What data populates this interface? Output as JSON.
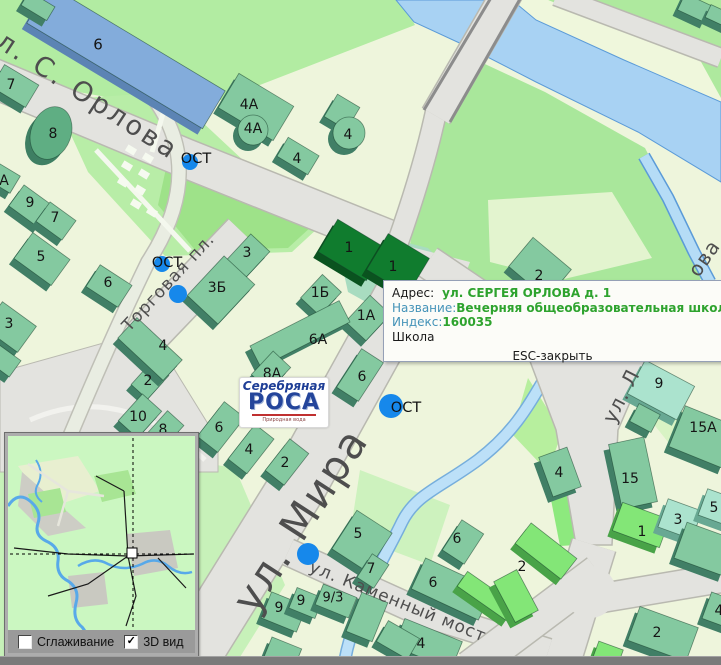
{
  "popup": {
    "address_label": "Адрес:",
    "address_value": "ул. СЕРГЕЯ ОРЛОВА д. 1",
    "name_label": "Название:",
    "name_value": "Вечерняя общеобразовательная школа № 1",
    "index_label": "Индекс:",
    "index_value": "160035",
    "category": "Школа",
    "close_hint": "ESC-закрыть"
  },
  "logo": {
    "line1": "Серебряная",
    "line2": "РОСА",
    "tagline": "Природная вода"
  },
  "minimap": {
    "smoothing_label": "Сглаживание",
    "smoothing_checked": false,
    "view3d_label": "3D вид",
    "view3d_checked": true
  },
  "colors": {
    "water": "#A8D2F3",
    "water_edge": "#5B9BD8",
    "road": "#E3E3DF",
    "road_edge": "#B9B9B0",
    "building_top": "#84C9A0",
    "building_side": "#417F66",
    "school_top": "#107C2E",
    "school_side": "#0A531F",
    "stop_blue": "#1688EB",
    "popup_value_green": "#2EA32E",
    "popup_label_blue": "#4493B8"
  },
  "map": {
    "street_labels": [
      {
        "t": "ул. С. Орлова",
        "x": 80,
        "y": 90,
        "rot": 33,
        "s": 27,
        "ls": 3
      },
      {
        "t": "Торговая пл.",
        "x": 168,
        "y": 282,
        "rot": -47,
        "s": 17,
        "ls": 1
      },
      {
        "t": "ул. Мира",
        "x": 300,
        "y": 520,
        "rot": -57,
        "s": 42,
        "ls": 2
      },
      {
        "t": "ул. Каменный мост",
        "x": 398,
        "y": 601,
        "rot": 22,
        "s": 17,
        "ls": 1
      },
      {
        "t": "ул. Л",
        "x": 621,
        "y": 396,
        "rot": -63,
        "s": 20,
        "ls": 1
      },
      {
        "t": "ова",
        "x": 704,
        "y": 258,
        "rot": -55,
        "s": 20,
        "ls": 1
      }
    ],
    "building_labels": [
      {
        "t": "6",
        "x": 98,
        "y": 44,
        "s": 15
      },
      {
        "t": "7",
        "x": 11,
        "y": 84
      },
      {
        "t": "8",
        "x": 53,
        "y": 133
      },
      {
        "t": "А",
        "x": 4,
        "y": 180
      },
      {
        "t": "9",
        "x": 30,
        "y": 202
      },
      {
        "t": "7",
        "x": 55,
        "y": 217
      },
      {
        "t": "5",
        "x": 41,
        "y": 256
      },
      {
        "t": "3",
        "x": 9,
        "y": 323
      },
      {
        "t": "6",
        "x": 108,
        "y": 282
      },
      {
        "t": "2",
        "x": 148,
        "y": 380
      },
      {
        "t": "10",
        "x": 138,
        "y": 416
      },
      {
        "t": "8",
        "x": 163,
        "y": 429
      },
      {
        "t": "6",
        "x": 219,
        "y": 427
      },
      {
        "t": "4",
        "x": 249,
        "y": 449
      },
      {
        "t": "2",
        "x": 285,
        "y": 462
      },
      {
        "t": "4А",
        "x": 249,
        "y": 104
      },
      {
        "t": "4А",
        "x": 253,
        "y": 128
      },
      {
        "t": "4",
        "x": 297,
        "y": 158
      },
      {
        "t": "4",
        "x": 348,
        "y": 134
      },
      {
        "t": "2",
        "x": 539,
        "y": 275
      },
      {
        "t": "3",
        "x": 247,
        "y": 252
      },
      {
        "t": "3Б",
        "x": 217,
        "y": 287
      },
      {
        "t": "1Б",
        "x": 320,
        "y": 292
      },
      {
        "t": "1А",
        "x": 366,
        "y": 315
      },
      {
        "t": "1",
        "x": 349,
        "y": 247
      },
      {
        "t": "1",
        "x": 393,
        "y": 266
      },
      {
        "t": "6А",
        "x": 318,
        "y": 339
      },
      {
        "t": "8А",
        "x": 272,
        "y": 373
      },
      {
        "t": "6",
        "x": 362,
        "y": 376
      },
      {
        "t": "4",
        "x": 163,
        "y": 345
      },
      {
        "t": "5",
        "x": 358,
        "y": 533
      },
      {
        "t": "7",
        "x": 371,
        "y": 568
      },
      {
        "t": "9",
        "x": 279,
        "y": 607
      },
      {
        "t": "9",
        "x": 301,
        "y": 600
      },
      {
        "t": "9/3",
        "x": 333,
        "y": 597,
        "s": 13
      },
      {
        "t": "6",
        "x": 457,
        "y": 538
      },
      {
        "t": "6",
        "x": 433,
        "y": 582
      },
      {
        "t": "4",
        "x": 421,
        "y": 643
      },
      {
        "t": "2",
        "x": 522,
        "y": 566
      },
      {
        "t": "9",
        "x": 659,
        "y": 383
      },
      {
        "t": "15А",
        "x": 703,
        "y": 427
      },
      {
        "t": "15",
        "x": 630,
        "y": 478
      },
      {
        "t": "4",
        "x": 559,
        "y": 472
      },
      {
        "t": "1",
        "x": 642,
        "y": 531
      },
      {
        "t": "3",
        "x": 678,
        "y": 519
      },
      {
        "t": "5",
        "x": 714,
        "y": 507
      },
      {
        "t": "2",
        "x": 657,
        "y": 632
      },
      {
        "t": "4",
        "x": 719,
        "y": 610
      }
    ],
    "bus_stops": [
      {
        "t": "ОСТ",
        "tx": 196,
        "ty": 158,
        "cx": 190,
        "cy": 162,
        "r": 8
      },
      {
        "t": "ОСТ",
        "tx": 167,
        "ty": 262,
        "cx": 162,
        "cy": 264,
        "r": 8
      },
      {
        "t": "ОСТ",
        "tx": 406,
        "ty": 407,
        "cx": 391,
        "cy": 406,
        "r": 12
      }
    ],
    "dots": [
      {
        "x": 178,
        "y": 294,
        "r": 9
      },
      {
        "x": 308,
        "y": 554,
        "r": 11
      }
    ]
  }
}
